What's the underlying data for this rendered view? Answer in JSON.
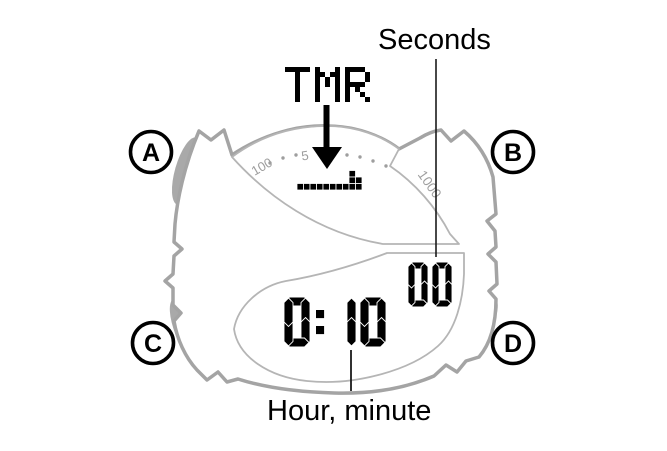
{
  "labels": {
    "seconds": "Seconds",
    "hour_minute": "Hour, minute",
    "mode": "TMR"
  },
  "display": {
    "hour_minute_value": "0:10",
    "seconds_value": "00"
  },
  "scale": {
    "left_label": "100",
    "mid_label": "5",
    "right_label": "1000"
  },
  "bar_graph": {
    "pattern": [
      "........#.",
      "........##",
      "##########"
    ]
  },
  "buttons": [
    {
      "id": "A",
      "label": "A"
    },
    {
      "id": "B",
      "label": "B"
    },
    {
      "id": "C",
      "label": "C"
    },
    {
      "id": "D",
      "label": "D"
    }
  ],
  "colors": {
    "case_gray": "#a4a4a4",
    "button_gray": "#a9a9a9",
    "lcd_outline_gray": "#b5b5b5",
    "scale_gray": "#9e9e9e",
    "ink": "#000000"
  }
}
